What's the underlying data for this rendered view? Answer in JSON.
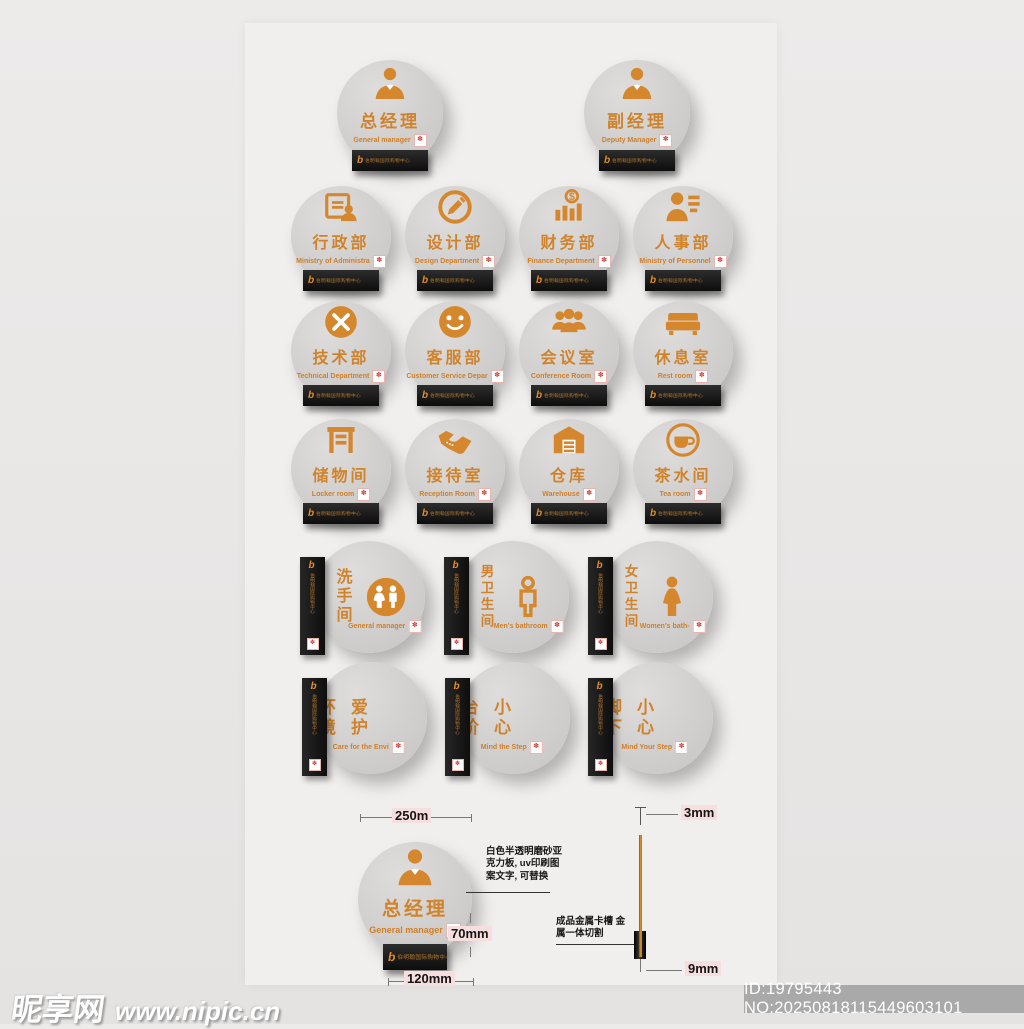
{
  "page": {
    "background": "#e8e6e5",
    "board_color": "#f1efee"
  },
  "colors": {
    "accent_orange": "#d5872e",
    "bar_black": "#1a1a1a",
    "badge_red": "#d2433c",
    "dim_highlight": "#f7dede"
  },
  "brand": {
    "logo": "b",
    "name": "伯明翰国际购物中心"
  },
  "badge_glyph": "✽",
  "signs": [
    {
      "title": "总经理",
      "subtitle": "General manager",
      "icon": "manager",
      "type": "h"
    },
    {
      "title": "副经理",
      "subtitle": "Deputy Manager",
      "icon": "manager",
      "type": "h"
    },
    {
      "title": "行政部",
      "subtitle": "Ministry of Administra",
      "icon": "admin",
      "type": "h"
    },
    {
      "title": "设计部",
      "subtitle": "Design Department",
      "icon": "design",
      "type": "h"
    },
    {
      "title": "财务部",
      "subtitle": "Finance Department",
      "icon": "finance",
      "type": "h"
    },
    {
      "title": "人事部",
      "subtitle": "Ministry of Personnel",
      "icon": "personnel",
      "type": "h"
    },
    {
      "title": "技术部",
      "subtitle": "Technical Department",
      "icon": "tech",
      "type": "h"
    },
    {
      "title": "客服部",
      "subtitle": "Customer Service Depar",
      "icon": "service",
      "type": "h"
    },
    {
      "title": "会议室",
      "subtitle": "Conference Room",
      "icon": "meeting",
      "type": "h"
    },
    {
      "title": "休息室",
      "subtitle": "Rest room",
      "icon": "rest",
      "type": "h"
    },
    {
      "title": "储物间",
      "subtitle": "Locker room",
      "icon": "locker",
      "type": "h"
    },
    {
      "title": "接待室",
      "subtitle": "Reception Room",
      "icon": "reception",
      "type": "h"
    },
    {
      "title": "仓库",
      "subtitle": "Warehouse",
      "icon": "warehouse",
      "type": "h"
    },
    {
      "title": "茶水间",
      "subtitle": "Tea room",
      "icon": "tea",
      "type": "h"
    },
    {
      "title": "洗手间",
      "subtitle": "General manager",
      "icon": "wc",
      "type": "v"
    },
    {
      "title": "男卫生间",
      "subtitle": "Men's bathroom",
      "icon": "male",
      "type": "v"
    },
    {
      "title": "女卫生间",
      "subtitle": "Women's bath-",
      "icon": "female",
      "type": "v"
    },
    {
      "title_cols": [
        "环境",
        "爱护"
      ],
      "subtitle": "Care for the Envi",
      "icon": "trash",
      "type": "v2"
    },
    {
      "title_cols": [
        "台阶",
        "小心"
      ],
      "subtitle": "Mind the Step",
      "icon": "stairs",
      "type": "v2"
    },
    {
      "title_cols": [
        "脚下",
        "小心"
      ],
      "subtitle": "Mind Your Step",
      "icon": "warning",
      "type": "v2"
    }
  ],
  "spec": {
    "example": {
      "title": "总经理",
      "subtitle": "General manager",
      "icon": "manager",
      "type": "h"
    },
    "dims": {
      "width": "250m",
      "plate_height": "70mm",
      "plate_width": "120mm",
      "thickness": "3mm",
      "base": "9mm"
    },
    "notes": {
      "material": "白色半透明磨砂亚克力板, uv印刷图案文字, 可替换",
      "holder": "成品金属卡槽 金属一体切割"
    }
  },
  "watermark": {
    "site": "昵享网",
    "url": "www.nipic.cn",
    "id": "ID:19795443 NO:20250818115449603101"
  }
}
